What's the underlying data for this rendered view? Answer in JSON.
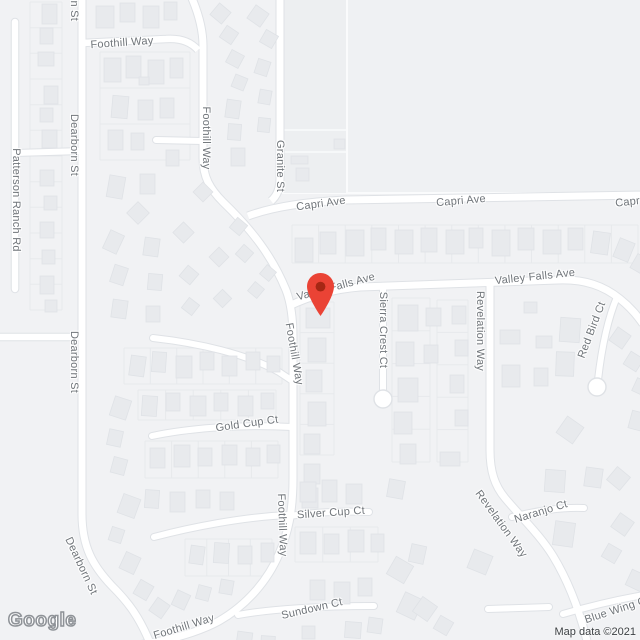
{
  "map": {
    "street_labels": [
      {
        "text": "Dearborn St",
        "x": 74,
        "y": -10,
        "rotate": 90
      },
      {
        "text": "Foothill Way",
        "x": 122,
        "y": 43,
        "rotate": -4
      },
      {
        "text": "Dearborn St",
        "x": 74,
        "y": 145,
        "rotate": 90
      },
      {
        "text": "Patterson Ranch Rd",
        "x": 16,
        "y": 200,
        "rotate": 90
      },
      {
        "text": "Foothill Way",
        "x": 206,
        "y": 138,
        "rotate": 90
      },
      {
        "text": "Granite St",
        "x": 280,
        "y": 166,
        "rotate": 90
      },
      {
        "text": "Capri Ave",
        "x": 321,
        "y": 204,
        "rotate": -8
      },
      {
        "text": "Capri Ave",
        "x": 461,
        "y": 201,
        "rotate": -5
      },
      {
        "text": "Capri Ave",
        "x": 640,
        "y": 201,
        "rotate": -6
      },
      {
        "text": "Valley Falls Ave",
        "x": 336,
        "y": 287,
        "rotate": -15
      },
      {
        "text": "Valley Falls Ave",
        "x": 535,
        "y": 277,
        "rotate": -6
      },
      {
        "text": "Sierra Crest Ct",
        "x": 383,
        "y": 330,
        "rotate": 90
      },
      {
        "text": "Revelation Way",
        "x": 480,
        "y": 331,
        "rotate": 90
      },
      {
        "text": "Red Bird Ct",
        "x": 592,
        "y": 330,
        "rotate": -69
      },
      {
        "text": "Foothill Way",
        "x": 294,
        "y": 354,
        "rotate": 80
      },
      {
        "text": "Gold Cup Ct",
        "x": 247,
        "y": 424,
        "rotate": -8
      },
      {
        "text": "Foothill Way",
        "x": 282,
        "y": 525,
        "rotate": 88
      },
      {
        "text": "Silver Cup Ct",
        "x": 331,
        "y": 513,
        "rotate": -4
      },
      {
        "text": "Naranjo Ct",
        "x": 541,
        "y": 512,
        "rotate": -17
      },
      {
        "text": "Revelation Way",
        "x": 501,
        "y": 524,
        "rotate": 54
      },
      {
        "text": "Dearborn St",
        "x": 74,
        "y": 362,
        "rotate": 90
      },
      {
        "text": "Dearborn St",
        "x": 81,
        "y": 566,
        "rotate": 65
      },
      {
        "text": "Sundown Ct",
        "x": 312,
        "y": 609,
        "rotate": -13
      },
      {
        "text": "Blue Wing Ct",
        "x": 617,
        "y": 610,
        "rotate": -18
      },
      {
        "text": "Foothill Way",
        "x": 184,
        "y": 627,
        "rotate": -17
      }
    ],
    "marker": {
      "tip_x": 320,
      "tip_y": 316,
      "body_color": "#EA4335",
      "dot_color": "#A52714"
    }
  },
  "colors": {
    "land": "#f1f2f4",
    "big_block": "#eff1f3",
    "big_block_strip": "#edeff1",
    "road_fill": "#ffffff",
    "road_casing": "#dfe2e6",
    "building_fill": "#e8eaed",
    "building_stroke": "#dfe2e6",
    "parcel_line": "#e7e9ec",
    "label_text": "#70757a"
  },
  "attribution": {
    "logo_text": "Google",
    "map_data_text": "Map data ©2021"
  }
}
